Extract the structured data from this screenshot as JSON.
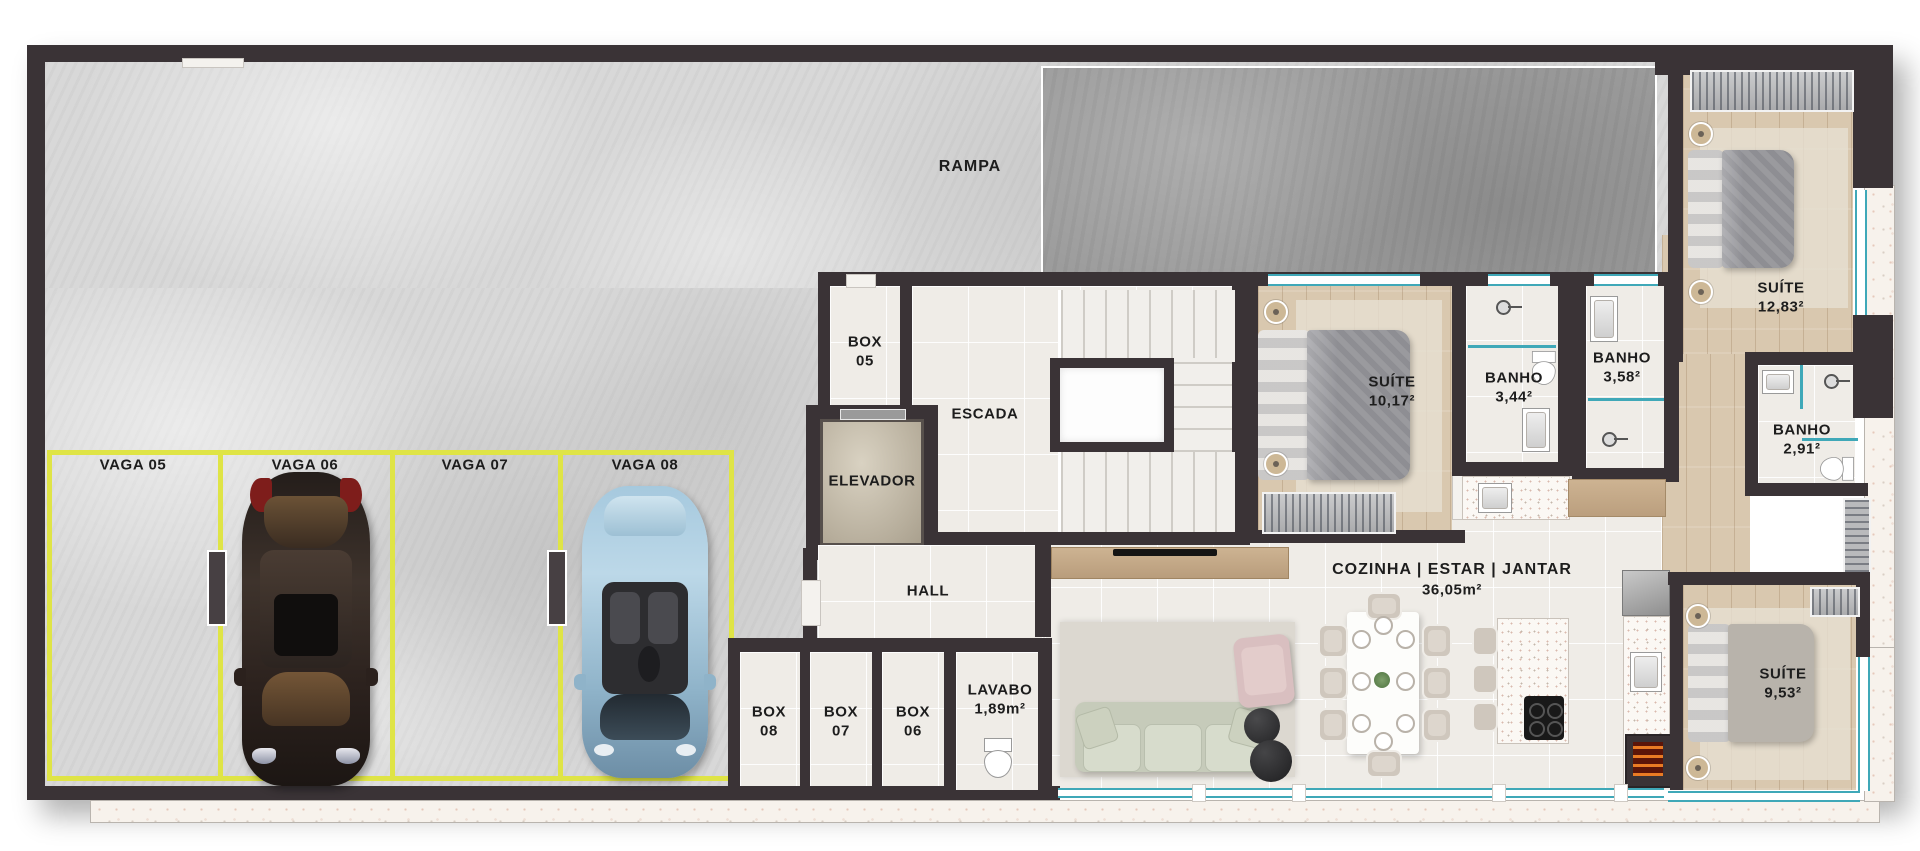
{
  "plan": {
    "garage": {
      "ramp_label": "RAMPA",
      "parking_spaces": [
        {
          "label": "VAGA 05",
          "occupied": false
        },
        {
          "label": "VAGA 06",
          "occupied": true,
          "car": "dark-sedan"
        },
        {
          "label": "VAGA 07",
          "occupied": false
        },
        {
          "label": "VAGA 08",
          "occupied": true,
          "car": "light-blue-convertible"
        }
      ],
      "storage_boxes": [
        {
          "line1": "BOX",
          "line2": "05"
        },
        {
          "line1": "BOX",
          "line2": "08"
        },
        {
          "line1": "BOX",
          "line2": "07"
        },
        {
          "line1": "BOX",
          "line2": "06"
        }
      ]
    },
    "core": {
      "stairs_label": "ESCADA",
      "elevator_label": "ELEVADOR",
      "hall_label": "HALL"
    },
    "rooms": {
      "lavabo": {
        "name": "LAVABO",
        "area": "1,89m²"
      },
      "suite_a": {
        "name": "SUÍTE",
        "area": "10,17²"
      },
      "banho_a": {
        "name": "BANHO",
        "area": "3,44²"
      },
      "banho_b": {
        "name": "BANHO",
        "area": "3,58²"
      },
      "suite_b": {
        "name": "SUÍTE",
        "area": "12,83²"
      },
      "banho_c": {
        "name": "BANHO",
        "area": "2,91²"
      },
      "living": {
        "name": "COZINHA | ESTAR | JANTAR",
        "area": "36,05m²"
      },
      "suite_c": {
        "name": "SUÍTE",
        "area": "9,53²"
      }
    },
    "colors": {
      "wall": "#3a3336",
      "parking_line": "#dfe446",
      "window_glass": "#3fa8b8",
      "concrete": "#d8d8d8",
      "ramp_slab": "#9c9c9c",
      "tile": "#efece7",
      "wood": "#d9c8af",
      "terrazzo": "#f7f2ec"
    }
  }
}
